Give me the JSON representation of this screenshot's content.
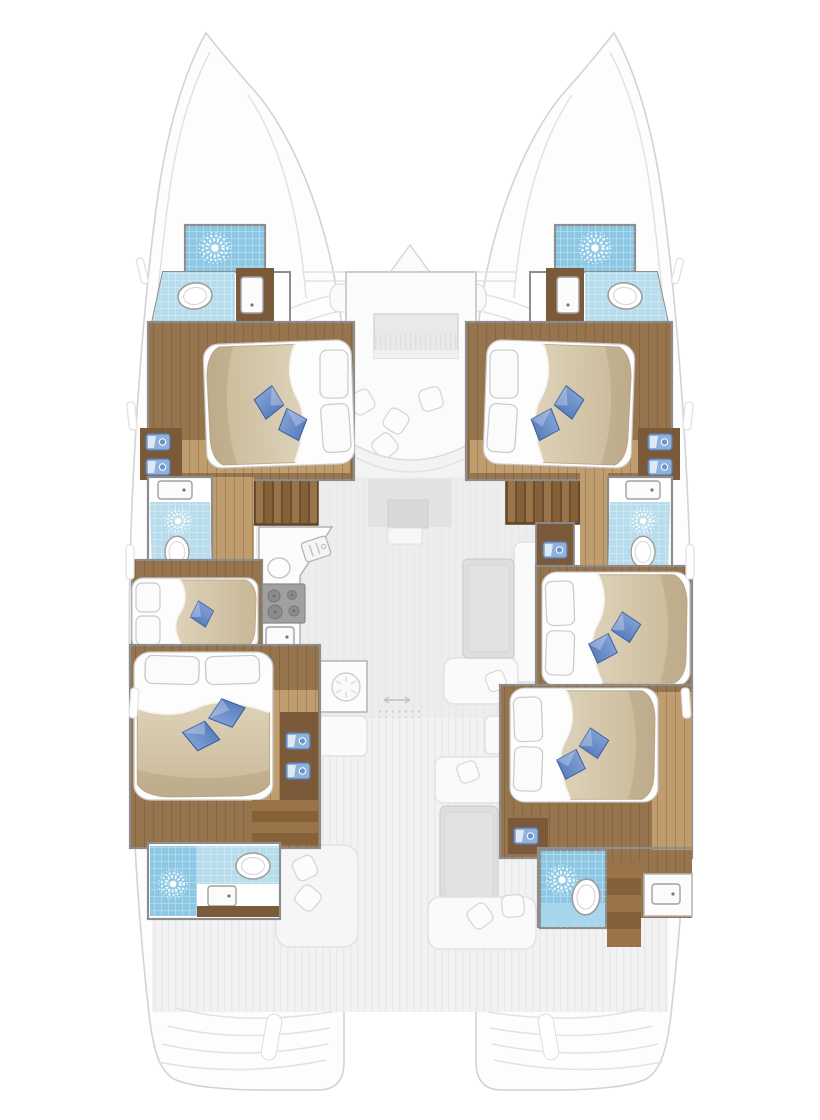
{
  "title": "Catamaran interior deck plan (top view, 6 cabins — no visible text in image)",
  "colors": {
    "hull_fill": "#fdfdfd",
    "hull_line": "#d3d3d3",
    "wall": "#8d8d8d",
    "wood": "#96744e",
    "wood_dark": "#7a5a38",
    "wood_floor": "#bf9d6f",
    "stair_light": "#9a7448",
    "stair_dark": "#85613a",
    "tile_blue": "#b7dcec",
    "shower_blue": "#8cc8e4",
    "sun_white": "#ffffff",
    "duvet": "#d6c9ae",
    "duvet_edge": "#bfae8d",
    "cushion_blue": "#5b82c5",
    "cushion_dark": "#3a5d9f",
    "mattress": "#fdfdfd",
    "salon_floor": "#ededed",
    "cockpit_floor": "#f2f2f2",
    "furniture_gray": "#dedede",
    "counter": "#fcfcfc",
    "stove": "#a0a0a0",
    "basin_blue": "#8fb2dd"
  },
  "layout_summary": {
    "cabins": 6,
    "bathrooms": 6,
    "shower_symbols": 6,
    "toilets": 6,
    "hulls": 2
  },
  "rooms": {
    "port_hull": [
      {
        "id": "port-fore-shower",
        "label": "shower"
      },
      {
        "id": "port-fore-head",
        "label": "bathroom with toilet and washbasin"
      },
      {
        "id": "port-fore-cabin",
        "label": "double cabin"
      },
      {
        "id": "port-mid-head",
        "label": "bathroom with shower and toilet"
      },
      {
        "id": "port-mid-cabin",
        "label": "single cabin"
      },
      {
        "id": "port-aft-cabin",
        "label": "double cabin"
      },
      {
        "id": "port-aft-head",
        "label": "bathroom with shower, toilet and washbasin"
      }
    ],
    "starboard_hull": [
      {
        "id": "stbd-fore-shower",
        "label": "shower"
      },
      {
        "id": "stbd-fore-head",
        "label": "bathroom with toilet and washbasin"
      },
      {
        "id": "stbd-fore-cabin",
        "label": "double cabin"
      },
      {
        "id": "stbd-mid-head",
        "label": "bathroom with shower and toilet"
      },
      {
        "id": "stbd-mid-cabin",
        "label": "double cabin"
      },
      {
        "id": "stbd-aft-cabin",
        "label": "double cabin"
      },
      {
        "id": "stbd-aft-head",
        "label": "bathroom with shower, toilet and washbasin"
      }
    ],
    "center": [
      {
        "id": "foredeck",
        "label": "bow deck with anchor locker"
      },
      {
        "id": "fore-lounge",
        "label": "forward cockpit lounge"
      },
      {
        "id": "salon",
        "label": "salon"
      },
      {
        "id": "nav-station",
        "label": "navigation station"
      },
      {
        "id": "galley",
        "label": "galley with stove and twin sinks"
      },
      {
        "id": "dinette",
        "label": "dinette table with bench"
      },
      {
        "id": "aft-cockpit",
        "label": "aft cockpit with sofa, table and sunpads"
      },
      {
        "id": "transoms",
        "label": "transom swim steps"
      }
    ]
  },
  "symbols": {
    "sun_burst": "shower-spray symbol",
    "blue_diamonds": "decor cushions",
    "white_ovals": "toilets",
    "small_blue_rects": "vanity basins",
    "wood_slats": "companionway stairs"
  }
}
